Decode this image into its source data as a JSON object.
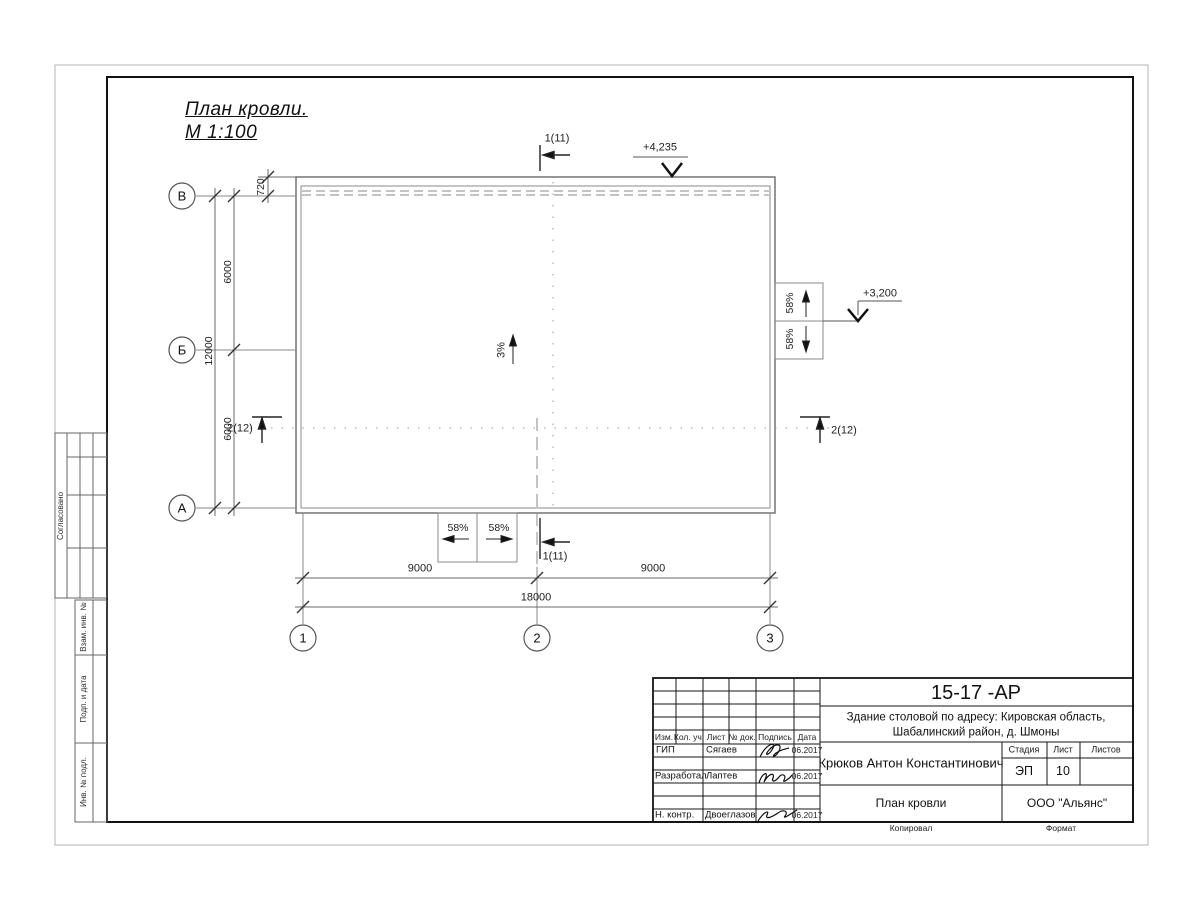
{
  "sheet": {
    "title1": "План кровли.",
    "title2": "М 1:100",
    "kopiroval": "Копировал",
    "format": "Формат"
  },
  "side": {
    "soglasovano": "Согласовано",
    "vzam": "Взам. инв. №",
    "podp": "Подп. и дата",
    "inv": "Инв. № подл."
  },
  "plan": {
    "row_axes": [
      "В",
      "Б",
      "А"
    ],
    "col_axes": [
      "1",
      "2",
      "3"
    ],
    "dim_720": "720",
    "dim_6000_top": "6000",
    "dim_12000": "12000",
    "dim_6000_bottom": "6000",
    "dim_9000_left": "9000",
    "dim_9000_right": "9000",
    "dim_18000": "18000",
    "slope_main": "3%",
    "slope_right_top": "58%",
    "slope_right_bottom": "58%",
    "slope_bottom_left": "58%",
    "slope_bottom_right": "58%",
    "elev_top": "+4,235",
    "elev_right": "+3,200",
    "section1_top": "1(11)",
    "section1_bottom": "1(11)",
    "section2_left": "2(12)",
    "section2_right": "2(12)"
  },
  "titleblock": {
    "doc_number": "15-17 -АР",
    "project_line1": "Здание столовой по адресу: Кировская область,",
    "project_line2": "Шабалинский район, д. Шмоны",
    "col_headers": [
      "Изм.",
      "Кол. уч.",
      "Лист",
      "№ док.",
      "Подпись",
      "Дата"
    ],
    "rows": [
      {
        "role": "ГИП",
        "name": "Сягаев",
        "date": "06.2017"
      },
      {
        "role": "Разработал",
        "name": "Лаптев",
        "date": "06.2017"
      },
      {
        "role": "Н. контр.",
        "name": "Двоеглазов",
        "date": "06.2017"
      }
    ],
    "author": "Крюков Антон Константинович",
    "stage_label": "Стадия",
    "list_label": "Лист",
    "listov_label": "Листов",
    "stage": "ЭП",
    "list_no": "10",
    "drawing_title": "План кровли",
    "company": "ООО \"Альянс\""
  },
  "colors": {
    "line": "#6a6a6a",
    "frame": "#111111",
    "text": "#1a1a1a"
  }
}
